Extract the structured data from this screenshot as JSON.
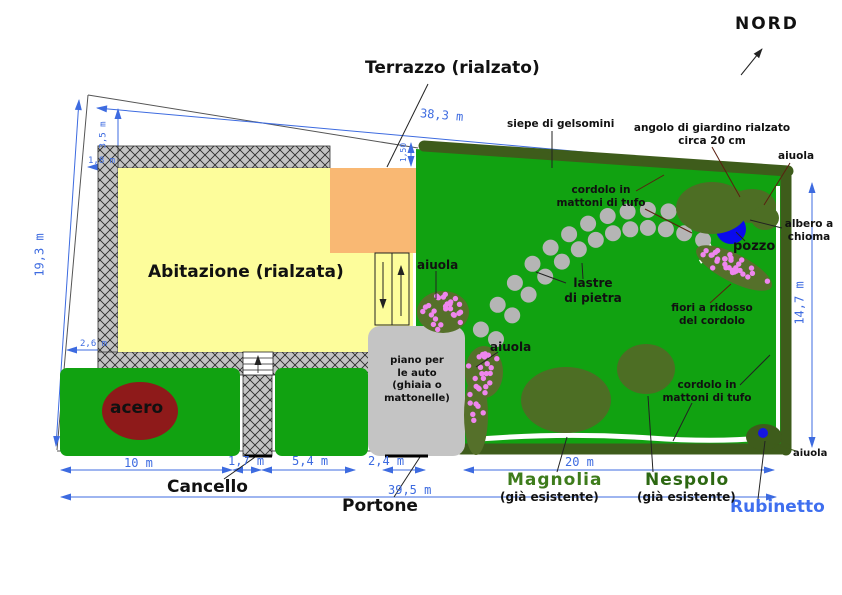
{
  "compass": {
    "label": "NORD"
  },
  "areas": {
    "terrace_title": "Terrazzo (rialzato)",
    "house": "Abitazione (rialzata)",
    "carport": "piano per\nle auto\n(ghiaia o\nmattonelle)",
    "maple": "acero"
  },
  "annotations": {
    "siepe": "siepe di gelsomini",
    "angolo": "angolo di giardino rialzato\ncirca 20 cm",
    "aiuola_top_right": "aiuola",
    "albero": "albero a\nchioma",
    "pozzo": "pozzo",
    "cordolo_top": "cordolo in\nmattoni di tufo",
    "lastre": "lastre\ndi pietra",
    "aiuola_terrace": "aiuola",
    "aiuola_carport": "aiuola",
    "fiori": "fiori a ridosso\ndel cordolo",
    "cordolo_bottom": "cordolo in\nmattoni di tufo",
    "aiuola_bottom_right": "aiuola",
    "rubinetto": "Rubinetto",
    "cancello": "Cancello",
    "portone": "Portone",
    "magnolia": "Magnolia",
    "magnolia_sub": "(già esistente)",
    "nespolo": "Nespolo",
    "nespolo_sub": "(già esistente)"
  },
  "dimensions": {
    "top": "38,3 m",
    "left": "19,3 m",
    "right": "14,7 m",
    "house_offset_top": "3,5 m",
    "house_offset_left": "1,8 m",
    "house_offset_bottom": "2,6 m",
    "terrace_side": "1,50",
    "hedge_left": "10 m",
    "gate": "1,7 m",
    "hedge_mid": "5,4 m",
    "portone_width": "2,4 m",
    "garden_width": "20 m",
    "total_bottom": "39,5 m"
  },
  "colors": {
    "grass": "#11a211",
    "hedge": "#3e5c1b",
    "tree": "#4d6e24",
    "flower_bed": "#55702a",
    "house_fill": "#fdfd9b",
    "terrace_fill": "#f9b873",
    "wall_gray": "#c3c3c3",
    "carport_gray": "#c4c4c4",
    "stone_gray": "#b5b5b5",
    "flower_pink": "#ee86ee",
    "well_blue": "#0a0aee",
    "maple_red": "#8e1a1a",
    "dimension_blue": "#3d6be0",
    "magnolia_text": "#3e7c1c",
    "nespolo_text": "#2d6812",
    "tap_text": "#3f6fef"
  }
}
